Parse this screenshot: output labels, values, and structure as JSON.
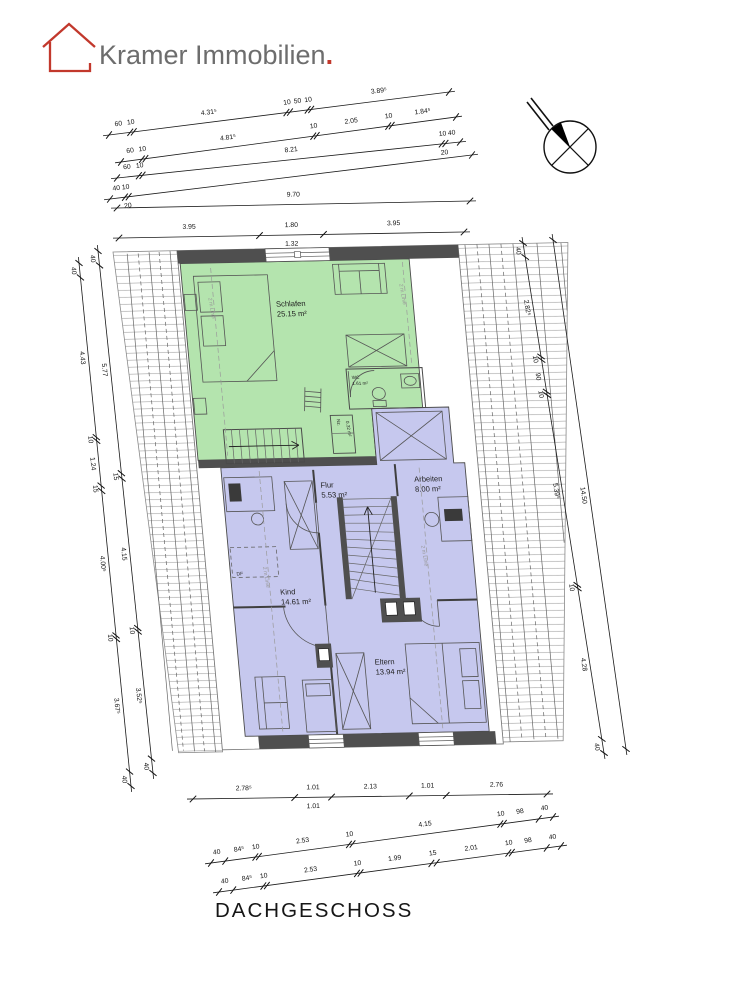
{
  "logo": {
    "name": "Kramer Immobilien",
    "period": ".",
    "colors": {
      "red": "#c2382c",
      "gray": "#6d6d6d"
    }
  },
  "title": "DACHGESCHOSS",
  "rooms": [
    {
      "id": "schlafen",
      "label": "Schlafen",
      "area": "25.15 m²"
    },
    {
      "id": "wc",
      "label": "WC",
      "area": "1.61 m²"
    },
    {
      "id": "nz",
      "label": "Nz.",
      "area": "0.32 m²"
    },
    {
      "id": "flur",
      "label": "Flur",
      "area": "5.53 m²"
    },
    {
      "id": "arbeiten",
      "label": "Arbeiten",
      "area": "8.00 m²"
    },
    {
      "id": "kind",
      "label": "Kind",
      "area": "14.61 m²"
    },
    {
      "id": "eltern",
      "label": "Eltern",
      "area": "13.94 m²"
    }
  ],
  "annotations": {
    "two_m_line": "2 m Linie",
    "df": "DF"
  },
  "colors": {
    "green_room": "#b4e4ae",
    "blue_room": "#c6c8ee",
    "wall": "#4f4f4f",
    "hatch_line": "#9a9a9a"
  },
  "dimension_chains": [
    {
      "id": "top-1",
      "x1": 109,
      "y1": 135,
      "x2": 449,
      "y2": 92,
      "side": 1,
      "segments": [
        {
          "label": "60",
          "m": 0.6
        },
        {
          "label": "10",
          "m": 0.1
        },
        {
          "label": "4.31⁵",
          "m": 4.315
        },
        {
          "label": "10",
          "m": 0.1
        },
        {
          "label": "50",
          "m": 0.5
        },
        {
          "label": "10",
          "m": 0.1
        },
        {
          "label": "3.89⁵",
          "m": 3.895
        }
      ]
    },
    {
      "id": "top-2",
      "x1": 121,
      "y1": 162,
      "x2": 456,
      "y2": 117,
      "side": 1,
      "segments": [
        {
          "label": "60",
          "m": 0.6
        },
        {
          "label": "10",
          "m": 0.1
        },
        {
          "label": "4.81⁵",
          "m": 4.815
        },
        {
          "label": "10",
          "m": 0.1
        },
        {
          "label": "2.05",
          "m": 2.05
        },
        {
          "label": "10",
          "m": 0.1
        },
        {
          "label": "1.84⁵",
          "m": 1.845
        }
      ]
    },
    {
      "id": "top-3",
      "x1": 117,
      "y1": 178,
      "x2": 460,
      "y2": 142,
      "side": 1,
      "segments": [
        {
          "label": "60",
          "m": 0.6
        },
        {
          "label": "10",
          "m": 0.1
        },
        {
          "label": "8.21",
          "m": 8.21
        },
        {
          "label": "10",
          "m": 0.1,
          "below": "20"
        },
        {
          "label": "40",
          "m": 0.4
        }
      ]
    },
    {
      "id": "top-4",
      "x1": 110,
      "y1": 199,
      "x2": 472,
      "y2": 155,
      "side": 1,
      "segments": [
        {
          "label": "40",
          "m": 0.4
        },
        {
          "label": "10",
          "m": 0.1,
          "below": "20"
        },
        {
          "label": "",
          "m": 9.2
        }
      ]
    },
    {
      "id": "top-5",
      "x1": 117,
      "y1": 208,
      "x2": 470,
      "y2": 201,
      "side": 1,
      "segments": [
        {
          "label": "9.70",
          "m": 9.7
        }
      ]
    },
    {
      "id": "top-6",
      "x1": 119,
      "y1": 238,
      "x2": 464,
      "y2": 232,
      "side": 1,
      "segments": [
        {
          "label": "3.95",
          "m": 3.95
        },
        {
          "label": "1.80",
          "m": 1.8,
          "below": "1.32"
        },
        {
          "label": "3.95",
          "m": 3.95
        }
      ]
    },
    {
      "id": "left-outer",
      "x1": 79,
      "y1": 263,
      "x2": 131,
      "y2": 786,
      "side": -1,
      "segments": [
        {
          "label": "40",
          "m": 0.4
        },
        {
          "label": "4.43",
          "m": 4.43
        },
        {
          "label": "10",
          "m": 0.1
        },
        {
          "label": "1.24",
          "m": 1.24
        },
        {
          "label": "15",
          "m": 0.15
        },
        {
          "label": "4.00⁵",
          "m": 4.005
        },
        {
          "label": "10",
          "m": 0.1
        },
        {
          "label": "3.67⁵",
          "m": 3.675
        },
        {
          "label": "40",
          "m": 0.4
        }
      ]
    },
    {
      "id": "left-inner",
      "x1": 98,
      "y1": 251,
      "x2": 153,
      "y2": 773,
      "side": -1,
      "segments": [
        {
          "label": "40",
          "m": 0.4
        },
        {
          "label": "5.77",
          "m": 5.77
        },
        {
          "label": "15",
          "m": 0.15
        },
        {
          "label": "4.15",
          "m": 4.15
        },
        {
          "label": "10",
          "m": 0.1
        },
        {
          "label": "3.52⁵",
          "m": 3.525
        },
        {
          "label": "40",
          "m": 0.4
        }
      ]
    },
    {
      "id": "right-inner",
      "x1": 523,
      "y1": 243,
      "x2": 604,
      "y2": 753,
      "side": -1,
      "segments": [
        {
          "label": "40",
          "m": 0.4
        },
        {
          "label": "2.82⁵",
          "m": 2.825
        },
        {
          "label": "10",
          "m": 0.1
        },
        {
          "label": "90",
          "m": 0.9
        },
        {
          "label": "10",
          "m": 0.1
        },
        {
          "label": "5.39⁵",
          "m": 5.395
        },
        {
          "label": "10",
          "m": 0.1
        },
        {
          "label": "4.28",
          "m": 4.28
        },
        {
          "label": "40",
          "m": 0.4
        }
      ]
    },
    {
      "id": "right-outer",
      "x1": 553,
      "y1": 240,
      "x2": 626,
      "y2": 749,
      "side": -1,
      "segments": [
        {
          "label": "14.50",
          "m": 14.5
        }
      ]
    },
    {
      "id": "bottom-1",
      "x1": 193,
      "y1": 799,
      "x2": 547,
      "y2": 794,
      "side": 1,
      "segments": [
        {
          "label": "2.78⁵",
          "m": 2.785
        },
        {
          "label": "1.01",
          "m": 1.01,
          "below": "1.01"
        },
        {
          "label": "2.13",
          "m": 2.13
        },
        {
          "label": "1.01",
          "m": 1.01
        },
        {
          "label": "2.76",
          "m": 2.76
        }
      ]
    },
    {
      "id": "bottom-2",
      "x1": 211,
      "y1": 863,
      "x2": 553,
      "y2": 817,
      "side": 1,
      "segments": [
        {
          "label": "40",
          "m": 0.4
        },
        {
          "label": "84⁵",
          "m": 0.845
        },
        {
          "label": "10",
          "m": 0.1
        },
        {
          "label": "2.53",
          "m": 2.53
        },
        {
          "label": "10",
          "m": 0.1
        },
        {
          "label": "4.15",
          "m": 4.15
        },
        {
          "label": "10",
          "m": 0.1
        },
        {
          "label": "98",
          "m": 0.98
        },
        {
          "label": "40",
          "m": 0.4
        }
      ]
    },
    {
      "id": "bottom-3",
      "x1": 219,
      "y1": 892,
      "x2": 561,
      "y2": 846,
      "side": 1,
      "segments": [
        {
          "label": "40",
          "m": 0.4
        },
        {
          "label": "84⁵",
          "m": 0.845
        },
        {
          "label": "10",
          "m": 0.1
        },
        {
          "label": "2.53",
          "m": 2.53
        },
        {
          "label": "10",
          "m": 0.1
        },
        {
          "label": "1.99",
          "m": 1.99
        },
        {
          "label": "15",
          "m": 0.15
        },
        {
          "label": "2.01",
          "m": 2.01
        },
        {
          "label": "10",
          "m": 0.1
        },
        {
          "label": "98",
          "m": 0.98
        },
        {
          "label": "40",
          "m": 0.4
        }
      ]
    }
  ]
}
